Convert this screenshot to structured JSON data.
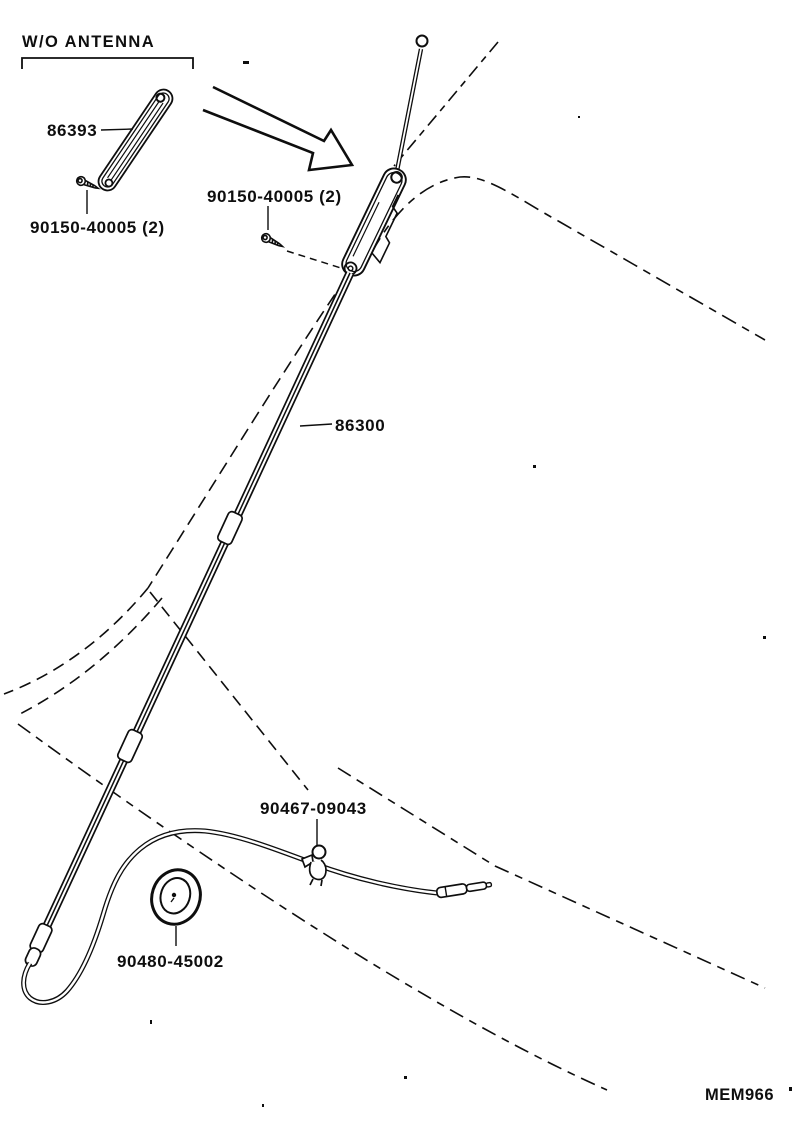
{
  "diagram": {
    "note": "W/O ANTENNA",
    "doc_code": "MEM966",
    "ink_color": "#0e0e0e",
    "background_color": "#ffffff",
    "labels": {
      "garnish": "86393",
      "screw_left": "90150-40005 (2)",
      "screw_right": "90150-40005 (2)",
      "mast": "86300",
      "clip": "90467-09043",
      "grommet": "90480-45002"
    }
  }
}
